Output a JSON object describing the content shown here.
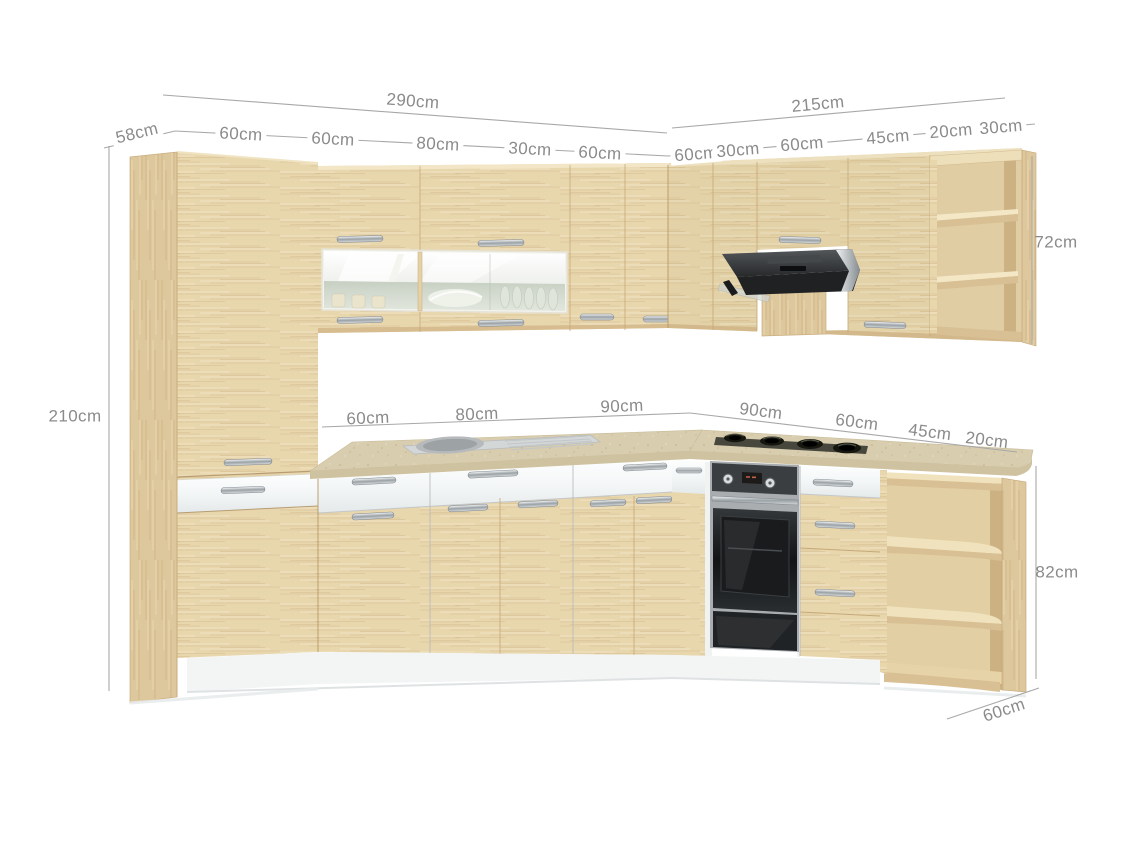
{
  "image": {
    "description": "L-shaped corner kitchen furniture set in light beech wood with white drawer fronts, shown with dimension annotations",
    "background": "#ffffff"
  },
  "palette": {
    "wood": "#e8d6ad",
    "wood_grain": "#d9c193",
    "wood_side": "#d8c094",
    "countertop": "#d8cdae",
    "white_fronts": "#f8fafa",
    "steel": "#a9adb0",
    "hood_dark": "#2c2e30",
    "dimension_text": "#8b8b8b",
    "dimension_line": "#a8a8a8"
  },
  "annotations": {
    "top_left_depth": "58cm",
    "top_left_total": "290cm",
    "top_right_total": "215cm",
    "top_segments_left": [
      "60cm",
      "60cm",
      "80cm",
      "30cm",
      "60cm"
    ],
    "top_segments_right": [
      "60cm",
      "30cm",
      "60cm",
      "45cm",
      "20cm",
      "30cm"
    ],
    "counter_segments_left": [
      "60cm",
      "80cm",
      "90cm"
    ],
    "counter_segments_right": [
      "90cm",
      "60cm",
      "45cm",
      "20cm"
    ],
    "tall_cabinet_height": "210cm",
    "wall_cabinet_height": "72cm",
    "base_cabinet_height": "82cm",
    "worktop_depth": "60cm"
  }
}
